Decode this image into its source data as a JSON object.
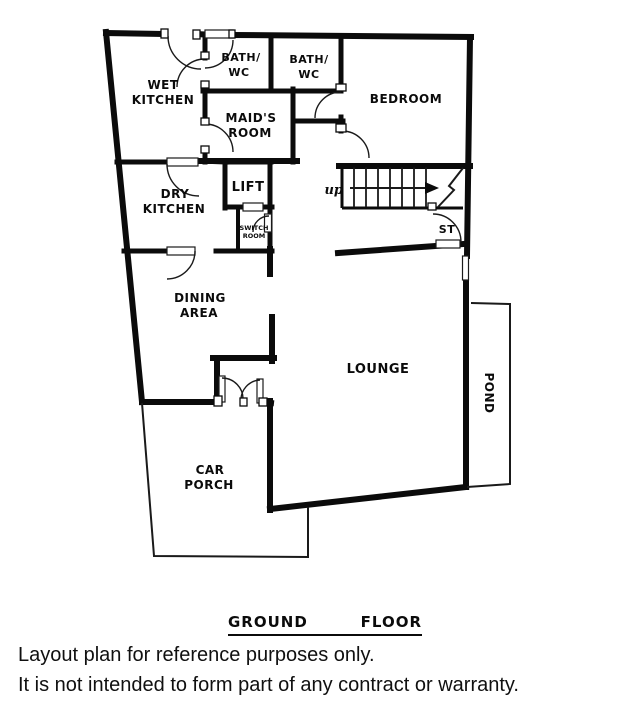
{
  "plan": {
    "rooms": {
      "wet_kitchen": [
        "WET",
        "KITCHEN"
      ],
      "bath_wc_1": [
        "BATH/",
        "WC"
      ],
      "bath_wc_2": [
        "BATH/",
        "WC"
      ],
      "maids_room": [
        "MAID'S",
        "ROOM"
      ],
      "bedroom": [
        "BEDROOM"
      ],
      "dry_kitchen": [
        "DRY",
        "KITCHEN"
      ],
      "lift": [
        "LIFT"
      ],
      "switch_room": [
        "SWITCH",
        "ROOM"
      ],
      "dining_area": [
        "DINING",
        "AREA"
      ],
      "lounge": [
        "LOUNGE"
      ],
      "car_porch": [
        "CAR",
        "PORCH"
      ],
      "pond": [
        "POND"
      ],
      "store": [
        "ST"
      ]
    },
    "stairs": {
      "direction_label": "up"
    },
    "colors": {
      "wall": "#0b0b0b",
      "background": "#ffffff"
    }
  },
  "title": {
    "word1": "GROUND",
    "word2": "FLOOR"
  },
  "disclaimer": {
    "line1": "Layout plan for reference purposes only.",
    "line2": "It is not intended to form part of any contract or warranty."
  }
}
